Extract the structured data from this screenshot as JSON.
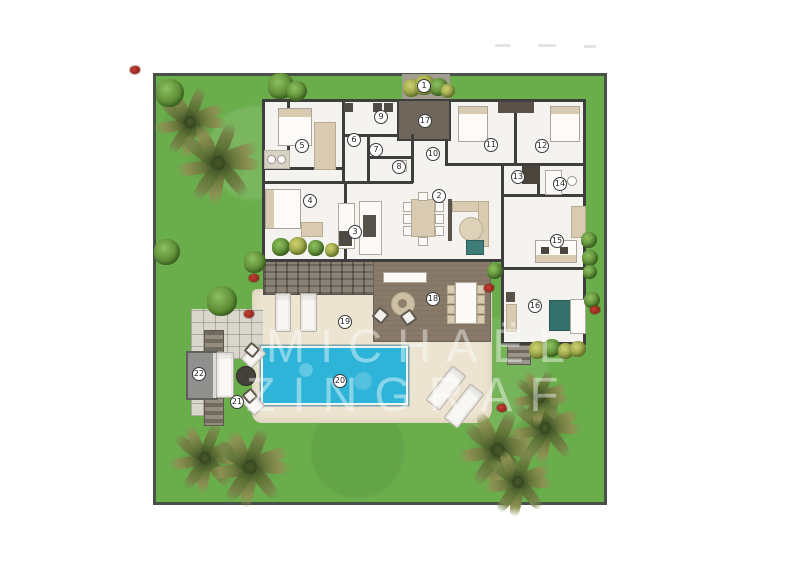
{
  "watermark": {
    "line1": "MICHAËL",
    "line2": "ZINGRAF",
    "color": "#ffffff",
    "opacity": 0.43
  },
  "palette": {
    "grass": "#6aae4c",
    "grass_border": "#475146",
    "pool": "#2eb4d8",
    "sand": "#ece3d0",
    "deck": "#887969",
    "walls": "#3e3e3c",
    "interior": "#f4f3f0",
    "dark_room": "#6f675c",
    "courtyard": "#a39c90",
    "furniture_beige": "#d8cbb2",
    "flower_red": "#a93226",
    "marker_bg": "#ffffff"
  },
  "plan": {
    "markers": [
      {
        "n": 1,
        "x": 424,
        "y": 86
      },
      {
        "n": 2,
        "x": 439,
        "y": 196
      },
      {
        "n": 3,
        "x": 355,
        "y": 232
      },
      {
        "n": 4,
        "x": 310,
        "y": 201
      },
      {
        "n": 5,
        "x": 302,
        "y": 146
      },
      {
        "n": 6,
        "x": 354,
        "y": 140
      },
      {
        "n": 7,
        "x": 376,
        "y": 150
      },
      {
        "n": 8,
        "x": 399,
        "y": 167
      },
      {
        "n": 9,
        "x": 381,
        "y": 117
      },
      {
        "n": 10,
        "x": 433,
        "y": 154
      },
      {
        "n": 11,
        "x": 491,
        "y": 145
      },
      {
        "n": 12,
        "x": 542,
        "y": 146
      },
      {
        "n": 13,
        "x": 518,
        "y": 177
      },
      {
        "n": 14,
        "x": 560,
        "y": 184
      },
      {
        "n": 15,
        "x": 557,
        "y": 241
      },
      {
        "n": 16,
        "x": 535,
        "y": 306
      },
      {
        "n": 17,
        "x": 425,
        "y": 121
      },
      {
        "n": 18,
        "x": 433,
        "y": 299
      },
      {
        "n": 19,
        "x": 345,
        "y": 322
      },
      {
        "n": 20,
        "x": 340,
        "y": 381
      },
      {
        "n": 21,
        "x": 237,
        "y": 402
      },
      {
        "n": 22,
        "x": 199,
        "y": 374
      }
    ],
    "vegetation": {
      "palms": [
        {
          "x": 190,
          "y": 122,
          "r": 36
        },
        {
          "x": 218,
          "y": 163,
          "r": 42
        },
        {
          "x": 205,
          "y": 458,
          "r": 36
        },
        {
          "x": 250,
          "y": 467,
          "r": 40
        },
        {
          "x": 498,
          "y": 450,
          "r": 40
        },
        {
          "x": 545,
          "y": 428,
          "r": 36
        },
        {
          "x": 518,
          "y": 482,
          "r": 34
        },
        {
          "x": 540,
          "y": 398,
          "r": 28
        }
      ],
      "bushes": [
        {
          "x": 170,
          "y": 93,
          "r": 14,
          "tone": "green"
        },
        {
          "x": 281,
          "y": 86,
          "r": 13,
          "tone": "green"
        },
        {
          "x": 297,
          "y": 91,
          "r": 10,
          "tone": "green"
        },
        {
          "x": 167,
          "y": 252,
          "r": 13,
          "tone": "green"
        },
        {
          "x": 222,
          "y": 301,
          "r": 15,
          "tone": "green"
        },
        {
          "x": 255,
          "y": 262,
          "r": 11,
          "tone": "green"
        },
        {
          "x": 281,
          "y": 247,
          "r": 9,
          "tone": "green"
        },
        {
          "x": 298,
          "y": 246,
          "r": 9,
          "tone": "yellow"
        },
        {
          "x": 316,
          "y": 248,
          "r": 8,
          "tone": "green"
        },
        {
          "x": 332,
          "y": 250,
          "r": 7,
          "tone": "yellow"
        },
        {
          "x": 495,
          "y": 271,
          "r": 8,
          "tone": "green"
        },
        {
          "x": 412,
          "y": 88,
          "r": 9,
          "tone": "yellow"
        },
        {
          "x": 425,
          "y": 85,
          "r": 10,
          "tone": "yellow"
        },
        {
          "x": 439,
          "y": 87,
          "r": 9,
          "tone": "green"
        },
        {
          "x": 448,
          "y": 91,
          "r": 7,
          "tone": "yellow"
        },
        {
          "x": 538,
          "y": 350,
          "r": 9,
          "tone": "yellow"
        },
        {
          "x": 552,
          "y": 348,
          "r": 9,
          "tone": "green"
        },
        {
          "x": 566,
          "y": 351,
          "r": 8,
          "tone": "yellow"
        },
        {
          "x": 578,
          "y": 349,
          "r": 8,
          "tone": "yellow"
        },
        {
          "x": 589,
          "y": 240,
          "r": 8,
          "tone": "green"
        },
        {
          "x": 590,
          "y": 258,
          "r": 8,
          "tone": "green"
        },
        {
          "x": 590,
          "y": 272,
          "r": 7,
          "tone": "green"
        },
        {
          "x": 592,
          "y": 300,
          "r": 8,
          "tone": "green"
        }
      ],
      "flowers": [
        {
          "x": 135,
          "y": 70
        },
        {
          "x": 254,
          "y": 278
        },
        {
          "x": 249,
          "y": 314
        },
        {
          "x": 489,
          "y": 288
        },
        {
          "x": 502,
          "y": 408
        },
        {
          "x": 595,
          "y": 310
        }
      ]
    }
  },
  "artifacts": {
    "smudges": [
      {
        "x": 495,
        "y": 44,
        "w": 16
      },
      {
        "x": 538,
        "y": 44,
        "w": 18
      },
      {
        "x": 584,
        "y": 45,
        "w": 12
      }
    ]
  }
}
